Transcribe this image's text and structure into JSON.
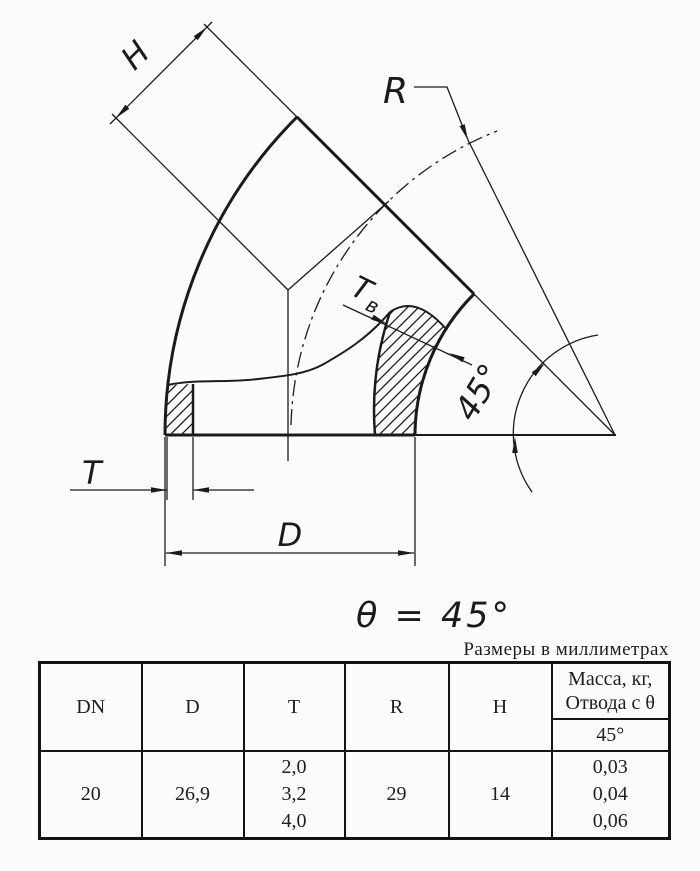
{
  "colors": {
    "ink": "#1b1b1b",
    "background": "#fcfcfc"
  },
  "drawing": {
    "h_label": "H",
    "r_label": "R",
    "tv_label_main": "T",
    "tv_label_sub": "в",
    "angle_label": "45°",
    "t_label": "T",
    "d_label": "D",
    "theta_note": "θ = 45°"
  },
  "caption": "Размеры в миллиметрах",
  "table": {
    "headers": [
      "DN",
      "D",
      "T",
      "R",
      "H"
    ],
    "mass_header_line1": "Масса, кг,",
    "mass_header_line2": "Отвода с θ",
    "mass_subheader": "45°",
    "row": {
      "dn": "20",
      "d": "26,9",
      "t": [
        "2,0",
        "3,2",
        "4,0"
      ],
      "r": "29",
      "h": "14",
      "mass": [
        "0,03",
        "0,04",
        "0,06"
      ]
    }
  }
}
